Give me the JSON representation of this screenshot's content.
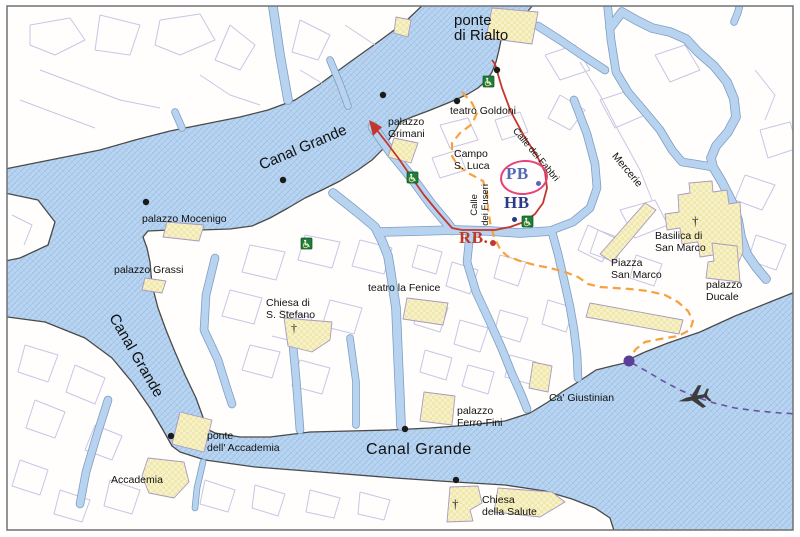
{
  "map": {
    "title": "Venice San Marco area map",
    "labels": {
      "ponte_di_rialto": {
        "l1": "ponte",
        "l2": "di Rialto"
      },
      "teatro_goldoni": "teatro Goldoni",
      "campo_s_luca": {
        "l1": "Campo",
        "l2": "S. Luca"
      },
      "calle_dei_fuseri": {
        "l1": "Calle",
        "l2": "dei Fuseri"
      },
      "calle_dei_fabbri": "Calle dei Fabbri",
      "mercerie": "Mercerie",
      "palazzo_grimani": {
        "l1": "palazzo",
        "l2": "Grimani"
      },
      "palazzo_mocenigo": "palazzo Mocenigo",
      "palazzo_grassi": "palazzo Grassi",
      "chiesa_s_stefano": {
        "l1": "Chiesa di",
        "l2": "S. Stefano"
      },
      "teatro_la_fenice": "teatro la Fenice",
      "canal_grande_upper": "Canal Grande",
      "canal_grande_left": "Canal Grande",
      "canal_grande_lower": "Canal Grande",
      "ponte_accademia": {
        "l1": "ponte",
        "l2": "dell' Accademia"
      },
      "accademia": "Accademia",
      "palazzo_ferro_fini": {
        "l1": "palazzo",
        "l2": "Ferro-Fini"
      },
      "ca_giustinian": "Ca' Giustinian",
      "chiesa_della_salute": {
        "l1": "Chiesa",
        "l2": "della Salute"
      },
      "basilica_san_marco": {
        "l1": "Basilica di",
        "l2": "San Marco"
      },
      "piazza_san_marco": {
        "l1": "Piazza",
        "l2": "San Marco"
      },
      "palazzo_ducale": {
        "l1": "palazzo",
        "l2": "Ducale"
      }
    },
    "markers": {
      "pb": "PB",
      "hb": "HB",
      "rb": "RB."
    },
    "icons": {
      "church_cross": "†",
      "airplane": "airplane-silhouette",
      "boarding": "vaporetto-boarding"
    },
    "colors": {
      "water": "#b9d5f0",
      "water_hatch": "#9dc1e6",
      "canal_fill": "#b7d3ef",
      "canal_edge": "#7d9ec4",
      "land": "#fffefc",
      "coast": "#4a4a4a",
      "street": "#c7c6e4",
      "building_fill": "#f6f1c9",
      "building_check": "#ebe093",
      "building_stroke": "#a79ac2",
      "route_red": "#c4372e",
      "route_orange": "#f6a13f",
      "route_purple": "#6a51a3",
      "marker_pb": "#5468b4",
      "marker_hb": "#2b3a85",
      "marker_rb": "#c0392b",
      "ellipse_pink": "#e8417c",
      "icon_green": "#1f7e3c",
      "dot_black": "#1a1a1a",
      "dot_purple": "#5b3f96",
      "plane": "#3c3c3c",
      "frame": "#707070",
      "label": "#111111"
    }
  }
}
